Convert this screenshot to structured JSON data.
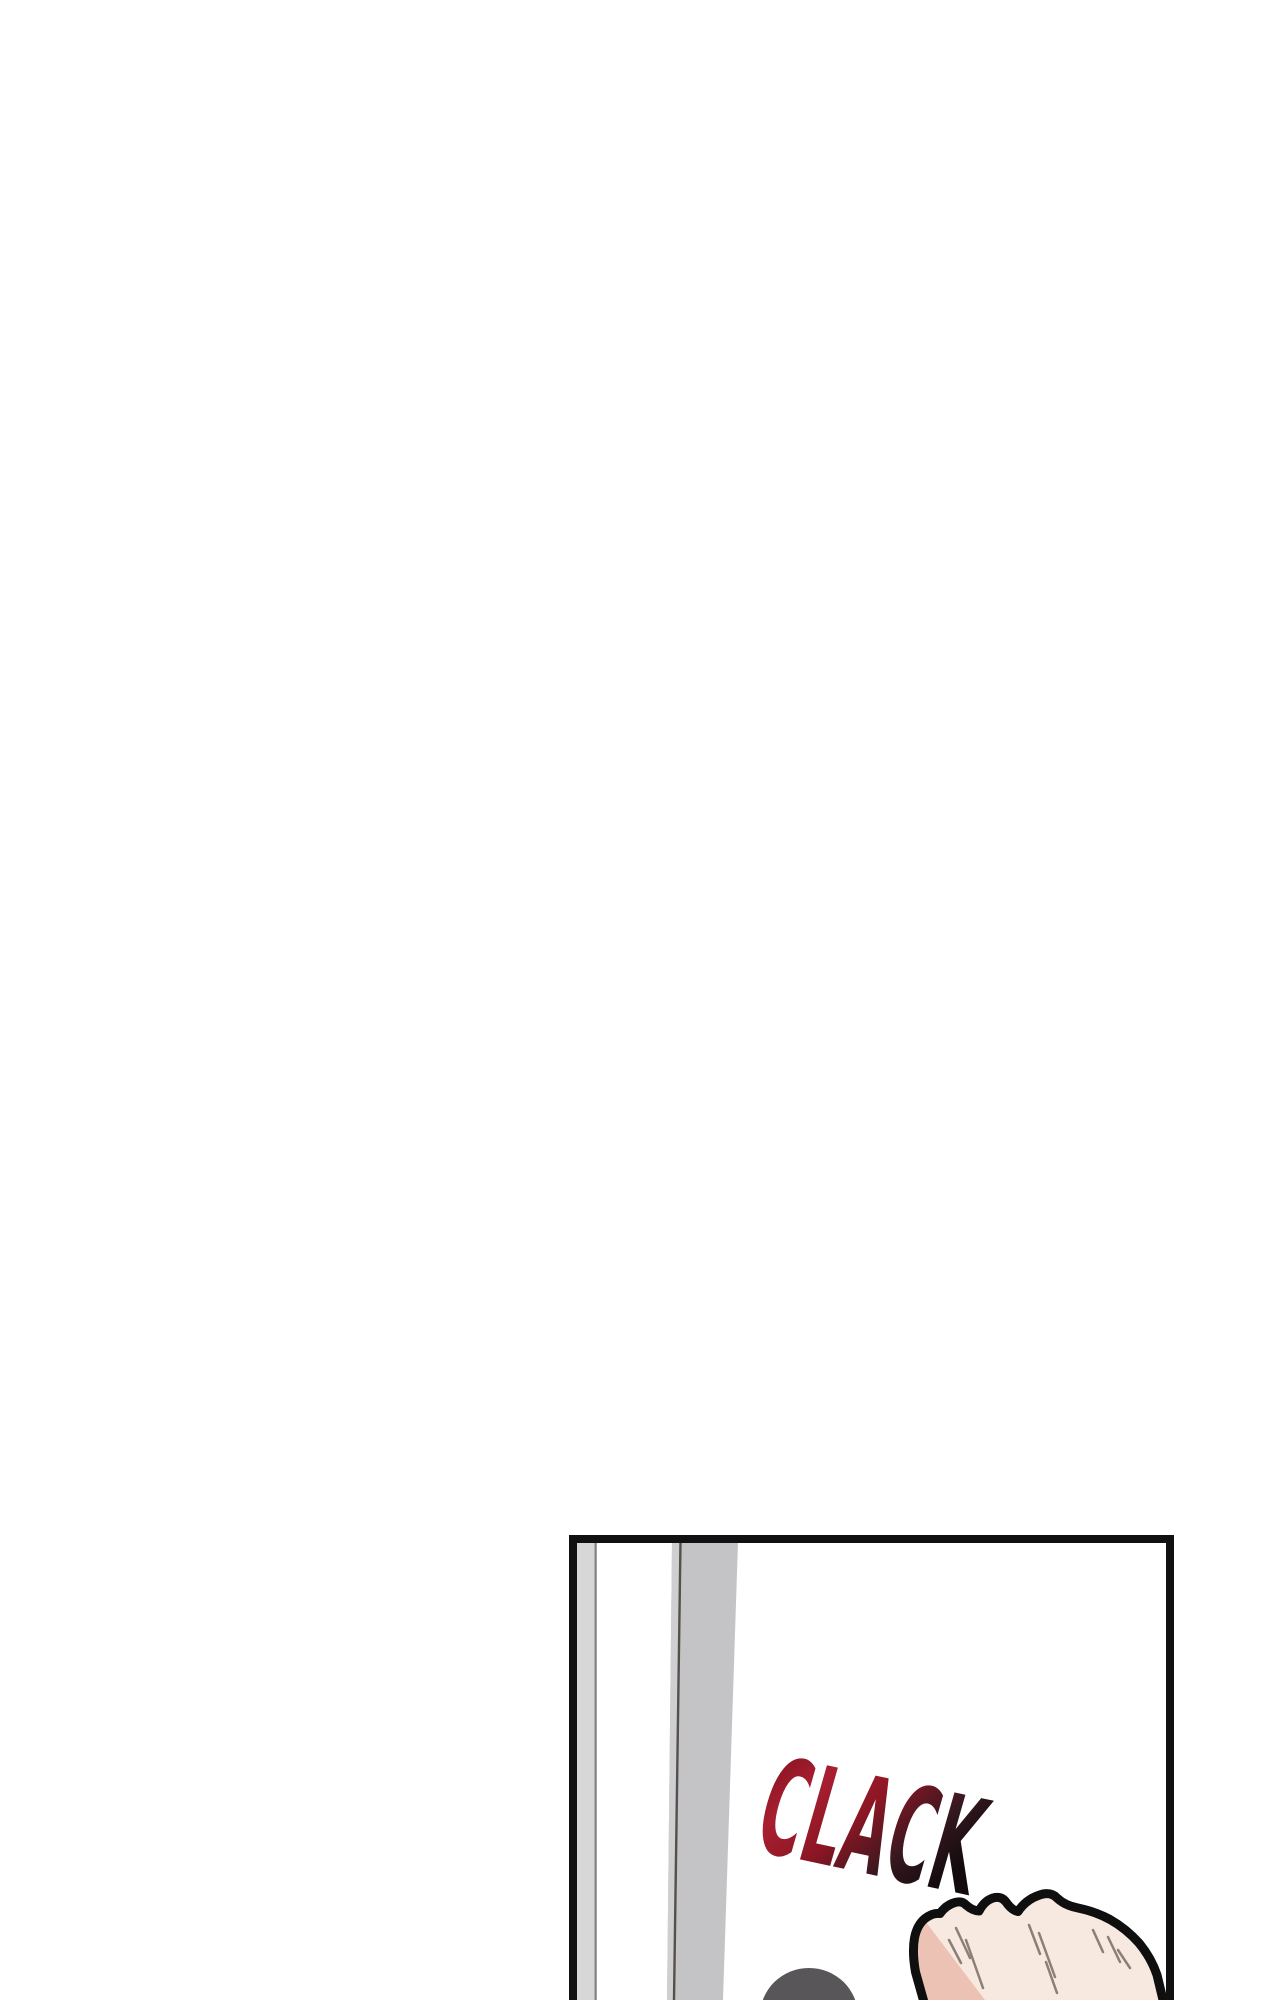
{
  "page": {
    "background": "#ffffff"
  },
  "panel": {
    "border_color": "#111111",
    "background": "#ffffff",
    "door": {
      "frame_bar_color": "#d7d7d7",
      "frame_bar_edge_color": "#858585",
      "door_bar_color": "#c4c4c6",
      "door_bar_highlight_color": "#cfcfd1",
      "door_seam_color": "#55504c"
    },
    "sfx": {
      "text": "CLACK",
      "gradient_stop_1": "#7d101d",
      "gradient_stop_2": "#a81f30",
      "gradient_stop_3": "#8c1624",
      "gradient_stop_4": "#34181f",
      "gradient_stop_5": "#120a0d"
    },
    "fist": {
      "skin_color": "#f7e9e0",
      "shadow_color": "#ecc2b5",
      "outline_color": "#0f0f0f",
      "crease_color": "#8d7f78"
    },
    "head": {
      "color": "#59565a"
    }
  }
}
